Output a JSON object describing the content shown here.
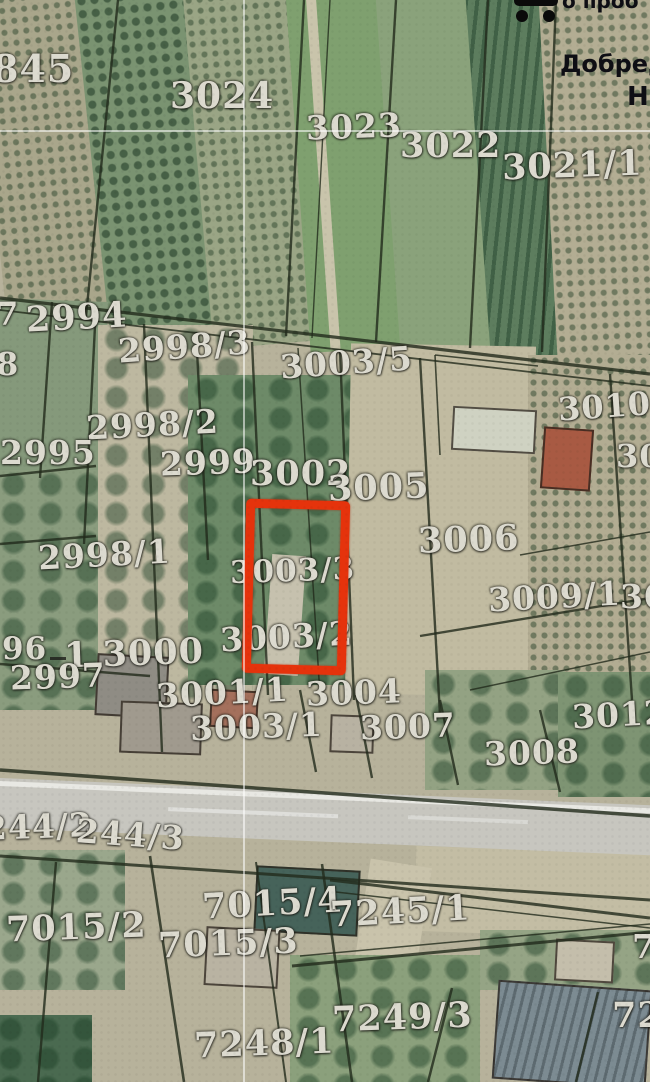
{
  "map": {
    "highlight_color": "#e5330c",
    "parcel_labels": [
      "845",
      "3024",
      "3023",
      "3022",
      "3021/1",
      "7",
      "2994",
      "2998/3",
      "3003/5",
      "3010/",
      "8",
      "2998/2",
      "2995",
      "2999",
      "300",
      "3002",
      "3005",
      "3006",
      "2998/1",
      "3003/3",
      "3009/1",
      "30",
      "3003/2",
      "96",
      "1 3000",
      "2997",
      "3001/1",
      "3004",
      "3003/1",
      "3007",
      "3012",
      "3008",
      "244/2",
      "244/3",
      "7015/4",
      "7245/1",
      "7015/2",
      "7015/3",
      "7",
      "7249/3",
      "72",
      "7248/1"
    ],
    "corner": {
      "top_text": "о проб",
      "line1": "Добред",
      "line2": "Н"
    },
    "icons": {
      "toolbar": "menu-dots-icon",
      "survey": "cross-mark"
    }
  }
}
